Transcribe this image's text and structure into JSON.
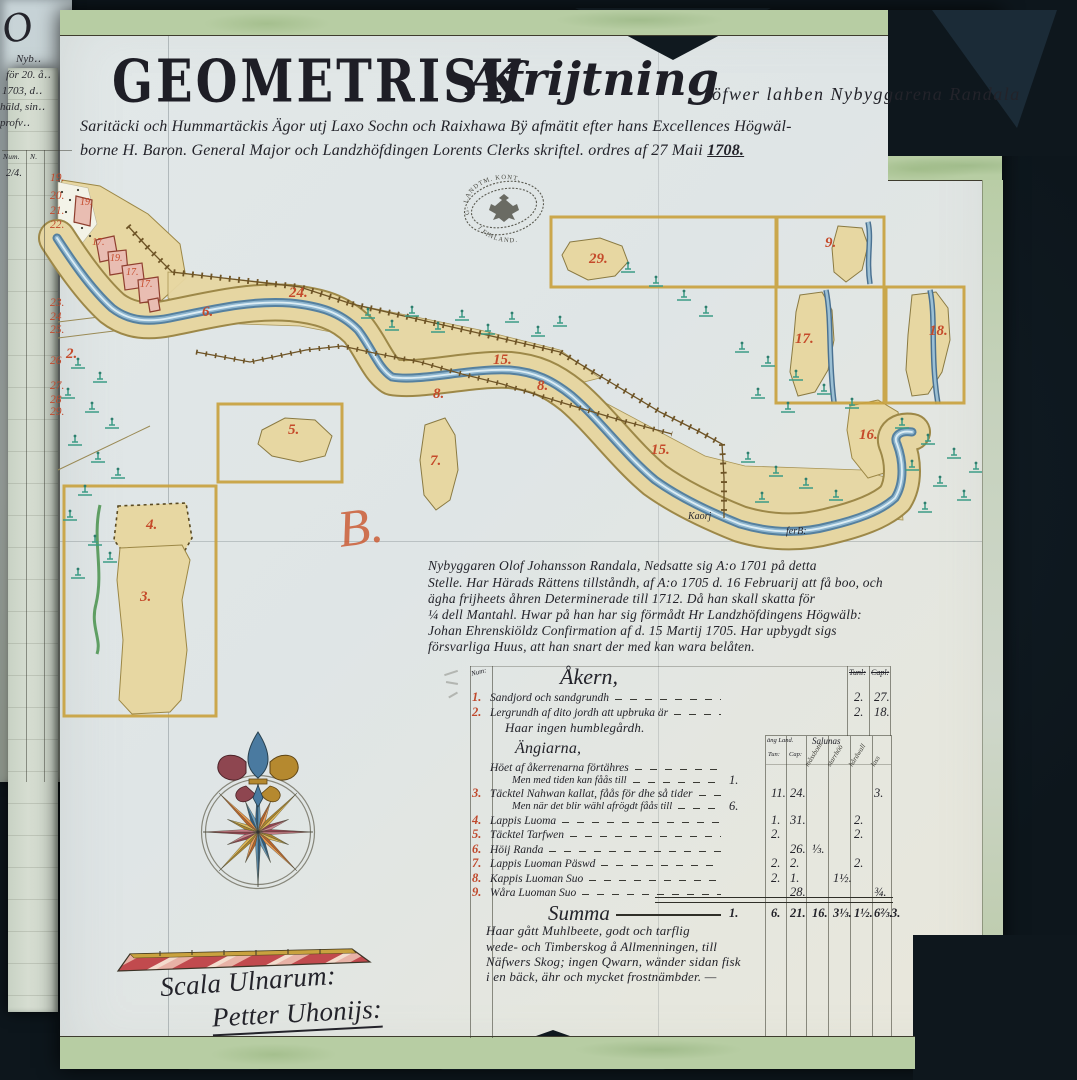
{
  "colors": {
    "background": "#0e171d",
    "paper": "#dfe5e4",
    "trim_green": "#b7cda3",
    "river_blue": "#6f9cbb",
    "parcel_tan": "#e7d7a2",
    "label_red": "#c54a2a",
    "ink": "#23232a"
  },
  "title": {
    "main": "GEOMETRISK",
    "script": "Afrijtning",
    "tail": "öfwer lahben Nybyggarena Randala",
    "line2": "Saritäcki och Hummartäckis Ägor utj Laxo Sochn och Raixhawa Bÿ afmätit efter hans Excellences Högwäl-",
    "line3": "borne H. Baron. General Major och Landzhöfdingen Lorents Clerks skriftel. ordres af 27 Maii",
    "year": "1708."
  },
  "seal": {
    "line_top": "G. LANDTM. KONT.",
    "line_bottom": "I FINLAND."
  },
  "map_labels": [
    {
      "t": "19.",
      "x": 80,
      "y": 197,
      "s": 1
    },
    {
      "t": "17.",
      "x": 92,
      "y": 237,
      "s": 1
    },
    {
      "t": "19.",
      "x": 110,
      "y": 253,
      "s": 1
    },
    {
      "t": "17.",
      "x": 126,
      "y": 267,
      "s": 1
    },
    {
      "t": "17.",
      "x": 140,
      "y": 279,
      "s": 1
    },
    {
      "t": "2.",
      "x": 66,
      "y": 346
    },
    {
      "t": "6.",
      "x": 202,
      "y": 304
    },
    {
      "t": "24.",
      "x": 289,
      "y": 285
    },
    {
      "t": "15.",
      "x": 493,
      "y": 352
    },
    {
      "t": "8.",
      "x": 433,
      "y": 386
    },
    {
      "t": "8.",
      "x": 537,
      "y": 378
    },
    {
      "t": "7.",
      "x": 430,
      "y": 453
    },
    {
      "t": "15.",
      "x": 651,
      "y": 442
    },
    {
      "t": "16.",
      "x": 859,
      "y": 427
    },
    {
      "t": "5.",
      "x": 288,
      "y": 422
    },
    {
      "t": "4.",
      "x": 146,
      "y": 517
    },
    {
      "t": "3.",
      "x": 140,
      "y": 589
    },
    {
      "t": "29.",
      "x": 589,
      "y": 251
    },
    {
      "t": "9.",
      "x": 825,
      "y": 235
    },
    {
      "t": "17.",
      "x": 795,
      "y": 331
    },
    {
      "t": "18.",
      "x": 929,
      "y": 323
    }
  ],
  "river_labels": [
    {
      "text": "Kaorj",
      "x": 688,
      "y": 511
    },
    {
      "text": "ferB:",
      "x": 786,
      "y": 526
    }
  ],
  "flourish_b": "B.",
  "paragraph": {
    "lines": [
      "Nybyggaren Olof Johansson Randala, Nedsatte sig A:o 1701 på detta",
      "Stelle. Har Härads Rättens tillståndh, af A:o 1705 d. 16 Februarij att få boo, och",
      "ägha frijheets åhren Determinerade till 1712. Då han skall skatta för",
      "¼ dell Mantahl. Hwar på han har sig förmådt Hr Landzhöfdingens Högwälb:",
      "Johan Ehrenskiöldz Confirmation af d. 15 Martij 1705. Har upbygdt sigs",
      "försvarliga Huus, att han snart der med kan wara belåten."
    ]
  },
  "table": {
    "num_header": "Num:",
    "akern_heading": "Åkern,",
    "right_cols": [
      "Tunl:",
      "Capl:"
    ],
    "angarna_heading": "Ängiarna,",
    "sub_header": {
      "group_left": "äng Land.",
      "group_right": "Salunas",
      "tun": "Tun:",
      "cap": "Cap:",
      "slanted": [
        "måssbotn",
        "starrhöö",
        "hårdwall",
        "lass"
      ]
    },
    "rows": [
      {
        "id": "r1",
        "num": "1.",
        "text": "Sandjord och sandgrundh",
        "c5": "2.",
        "c6": "27."
      },
      {
        "id": "r2",
        "num": "2.",
        "text": "Lergrundh af dito jordh att upbruka är",
        "c5": "2.",
        "c6": "18."
      },
      {
        "id": "note",
        "text": "Haar ingen humblegårdh.",
        "style": "note"
      },
      {
        "id": "angHead",
        "text": "Ängiarna,",
        "style": "heading"
      },
      {
        "id": "rA",
        "text": "Höet af åkerrenarna förtähres"
      },
      {
        "id": "rB",
        "text": "Men med tiden kan fåås till",
        "indent": 1,
        "pre": "1."
      },
      {
        "id": "r3",
        "num": "3.",
        "text": "Täcktel Nahwan kallat, fåås för dhe så tider",
        "c1": "11.",
        "c2": "24.",
        "c6": "3."
      },
      {
        "id": "r3b",
        "text": "Men när det blir wähl afrögdt fåås till",
        "indent": 1,
        "pre": "6."
      },
      {
        "id": "r4",
        "num": "4.",
        "text": "Lappis Luoma",
        "c1": "1.",
        "c2": "31.",
        "c5": "2."
      },
      {
        "id": "r5",
        "num": "5.",
        "text": "Täcktel Tarfwen",
        "c1": "2.",
        "c5": "2."
      },
      {
        "id": "r6",
        "num": "6.",
        "text": "Höij Randa",
        "c2": "26.",
        "c3": "⅓."
      },
      {
        "id": "r7",
        "num": "7.",
        "text": "Lappis Luoman Päswd",
        "c1": "2.",
        "c2": "2.",
        "c5": "2."
      },
      {
        "id": "r8",
        "num": "8.",
        "text": "Kappis Luoman Suo",
        "c1": "2.",
        "c2": "1.",
        "c4": "1½."
      },
      {
        "id": "r9",
        "num": "9.",
        "text": "Wåra Luoman Suo",
        "c2": "28.",
        "c6": "¾."
      }
    ],
    "summa": {
      "label": "Summa",
      "pre": "1.",
      "c1": "6.",
      "c2": "21.",
      "c3": "16.",
      "c4": "3⅓.",
      "c5": "1½.",
      "c6": "6⅔.",
      "post": "3."
    },
    "closing_lines": [
      "Haar gått Muhlbeete, godt och tarflig",
      "wede- och Timberskog å Allmenningen, till",
      "Näfwers Skog; ingen Qwarn, wänder sidan fisk",
      "i en bäck, ähr och mycket frostnämbder. —"
    ]
  },
  "scale": {
    "label": "Scala Ulnarum:",
    "signature": "Petter Uhonijs:"
  },
  "side_page": {
    "flourish": "O",
    "lines": [
      "Nyb‥",
      "för 20. å‥",
      "1703, d‥",
      "häld, sin‥",
      "profv‥"
    ],
    "header": [
      "Num.",
      "N."
    ],
    "mark": "2/4.",
    "numbers": [
      {
        "t": "19.",
        "y": 172
      },
      {
        "t": "20.",
        "y": 190
      },
      {
        "t": "21.",
        "y": 205
      },
      {
        "t": "22.",
        "y": 219
      },
      {
        "t": "23.",
        "y": 297
      },
      {
        "t": "24",
        "y": 311
      },
      {
        "t": "25.",
        "y": 324
      },
      {
        "t": "26",
        "y": 355
      },
      {
        "t": "27.",
        "y": 380
      },
      {
        "t": "28",
        "y": 394
      },
      {
        "t": "29.",
        "y": 406
      }
    ]
  }
}
